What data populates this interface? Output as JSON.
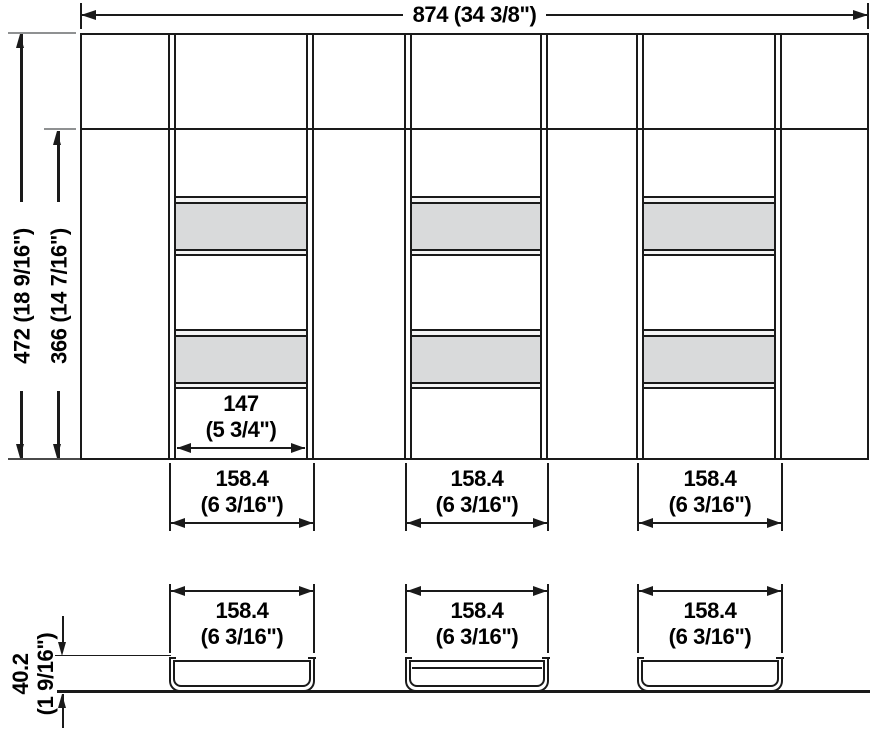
{
  "dimensions": {
    "overall_width": {
      "mm": "874",
      "inch": "(34 3/8\")"
    },
    "overall_depth": {
      "mm": "472",
      "inch": "(18 9/16\")"
    },
    "inner_depth": {
      "mm": "366",
      "inch": "(14 7/16\")"
    },
    "compartment_inner_width": {
      "mm": "147",
      "inch": "(5 3/4\")"
    },
    "profile_height": {
      "mm": "40.2",
      "inch": "(1 9/16\")"
    },
    "column_widths": [
      {
        "mm": "158.4",
        "inch": "(6 3/16\")"
      },
      {
        "mm": "158.4",
        "inch": "(6 3/16\")"
      },
      {
        "mm": "158.4",
        "inch": "(6 3/16\")"
      }
    ],
    "channel_widths": [
      {
        "mm": "158.4",
        "inch": "(6 3/16\")"
      },
      {
        "mm": "158.4",
        "inch": "(6 3/16\")"
      },
      {
        "mm": "158.4",
        "inch": "(6 3/16\")"
      }
    ]
  },
  "colors": {
    "line": "#1a1a1a",
    "band_fill": "#d9dadb",
    "rail_fill": "#f4f4f4",
    "extension_gray": "#8f9192"
  }
}
